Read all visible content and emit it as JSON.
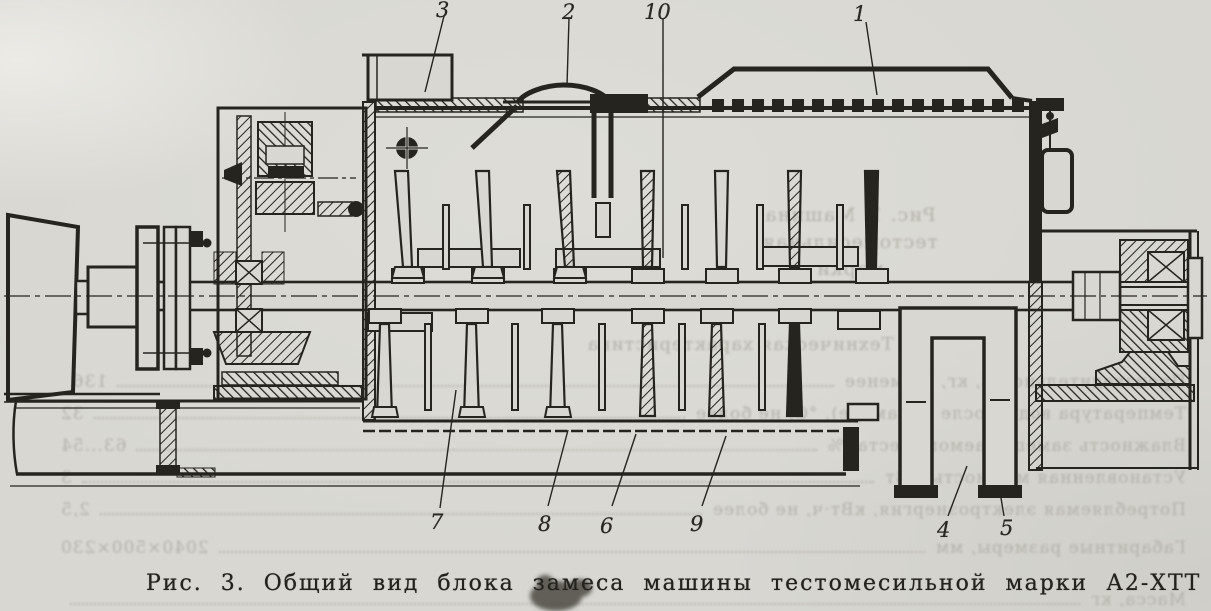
{
  "page": {
    "paper_color": "#d8d7d2",
    "ink_color": "#26241f",
    "bleed_color": "#b2b0a8"
  },
  "figure": {
    "caption": "Рис. 3. Общий вид блока замеса машины тестомесильной марки А2-ХТТ",
    "callouts": [
      {
        "label": "3"
      },
      {
        "label": "2"
      },
      {
        "label": "10"
      },
      {
        "label": "1"
      },
      {
        "label": "7"
      },
      {
        "label": "8"
      },
      {
        "label": "6"
      },
      {
        "label": "9"
      },
      {
        "label": "4"
      },
      {
        "label": "5"
      }
    ]
  },
  "bleed_through": {
    "fig1_caption_line1": "Рис. 1. Машина тестомесильная",
    "fig1_caption_line2": "марки",
    "spec_title": "Техническая характеристика",
    "spec_rows": [
      {
        "label": "Производительность, кг, не менее",
        "value": "1360"
      },
      {
        "label": "Температура воды после (в камере), °С, не более",
        "value": "32"
      },
      {
        "label": "Влажность замешиваемого теста, %",
        "value": "63...54"
      },
      {
        "label": "Установленная мощность, кВт",
        "value": "3"
      },
      {
        "label": "Потребляемая электроэнергия, кВт·ч, не более",
        "value": "2,5"
      },
      {
        "label": "Габаритные размеры, мм",
        "value": "2040×500×230"
      },
      {
        "label": "Масса, кг",
        "value": ""
      }
    ]
  }
}
